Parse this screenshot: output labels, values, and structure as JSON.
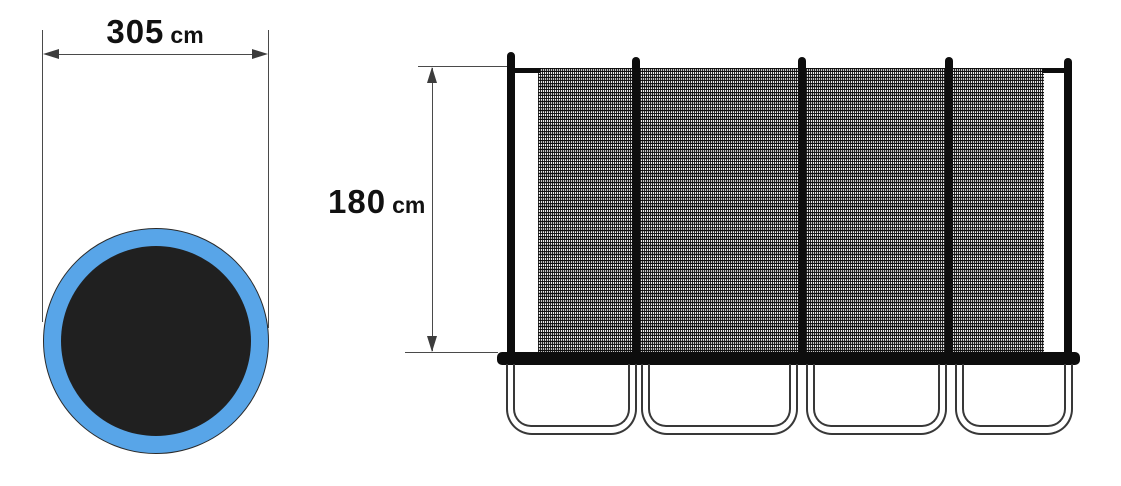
{
  "page": {
    "background_color": "#ffffff",
    "description_colors": {
      "dimension_line": "#4a4a4a",
      "arrowhead": "#3c3c3c",
      "structure_black": "#0d0d0d",
      "ring_blue": "#58a5e8",
      "mat_black": "#202020"
    }
  },
  "top_view": {
    "dimension_value": "305",
    "dimension_unit": "cm"
  },
  "side_view": {
    "dimension_value": "180",
    "dimension_unit": "cm",
    "pole_count": 5,
    "leg_count": 4
  }
}
